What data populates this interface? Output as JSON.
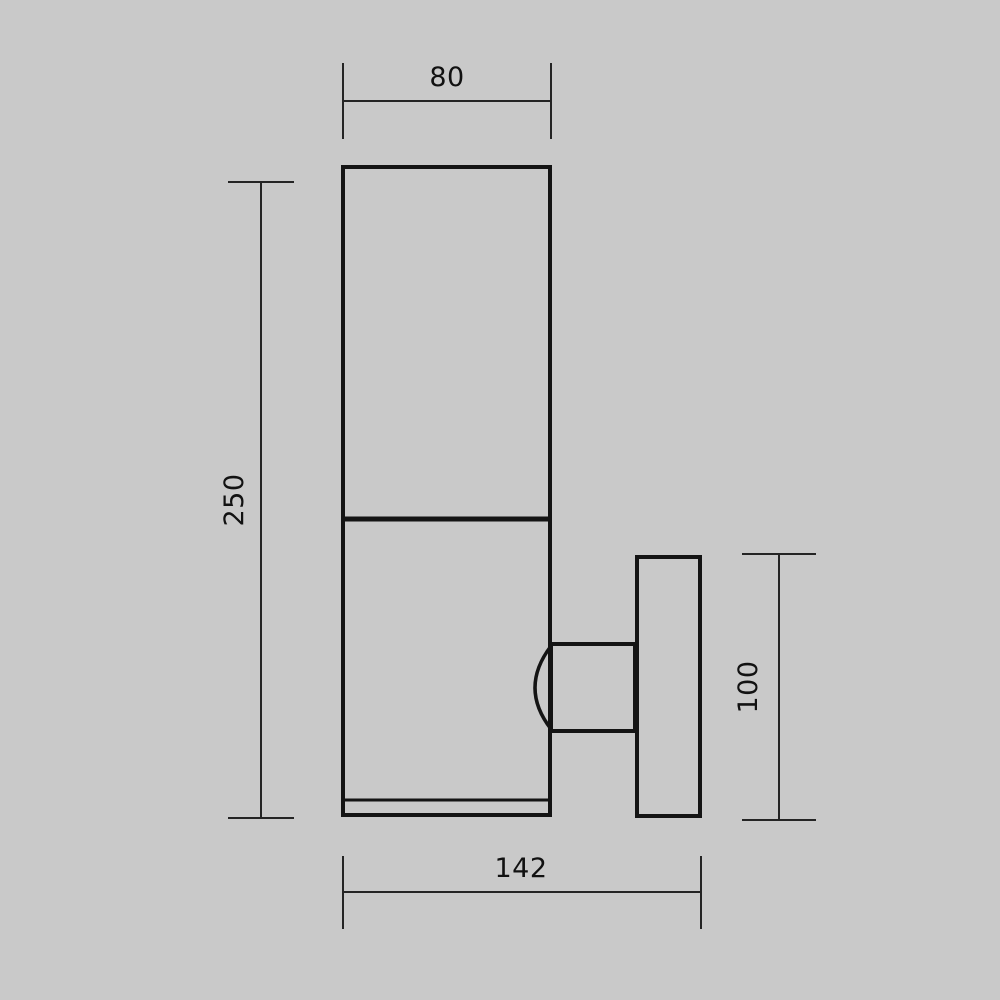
{
  "drawing": {
    "type": "technical-dimension-drawing",
    "subject": "wall-mounted cylindrical outdoor lamp, side elevation",
    "dimensions": {
      "body_width": "80",
      "body_height": "250",
      "wall_plate_height": "100",
      "overall_depth": "142"
    },
    "colors": {
      "background": "#c9c9c9",
      "object_line": "#141414",
      "dimension_line": "#242424",
      "label_text": "#111111"
    }
  }
}
